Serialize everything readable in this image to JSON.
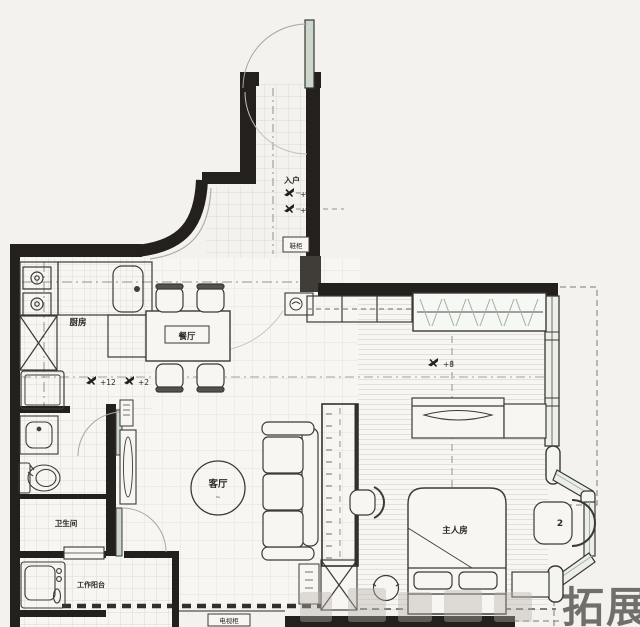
{
  "page": {
    "background": "#f3f2ef"
  },
  "colors": {
    "wall": "#23201d",
    "line": "#4a4743",
    "faint_line": "#b9b5af",
    "tile_grid": "#dcd9d3",
    "door_green": "#ccd6ca",
    "hanger_green": "#9fb39e",
    "watermark": "#b7b2ab"
  },
  "rooms": {
    "entry": {
      "label": "入户"
    },
    "kitchen": {
      "label": "厨房"
    },
    "dining": {
      "label": "餐厅"
    },
    "living": {
      "label": "客厅"
    },
    "bedroom": {
      "label": "主人房"
    },
    "bathroom": {
      "label": "卫生间"
    },
    "utility_balcony": {
      "label": "工作阳台"
    }
  },
  "fixtures": {
    "shoe_cabinet_label": "鞋柜",
    "tv_cabinet_label": "电视柜",
    "bay_chair_tag": "2"
  },
  "level_markers": [
    {
      "text": "+0"
    },
    {
      "text": "+2"
    },
    {
      "text": "+12"
    },
    {
      "text": "+2"
    },
    {
      "text": "+8"
    }
  ],
  "watermark": {
    "text": "拓展"
  }
}
